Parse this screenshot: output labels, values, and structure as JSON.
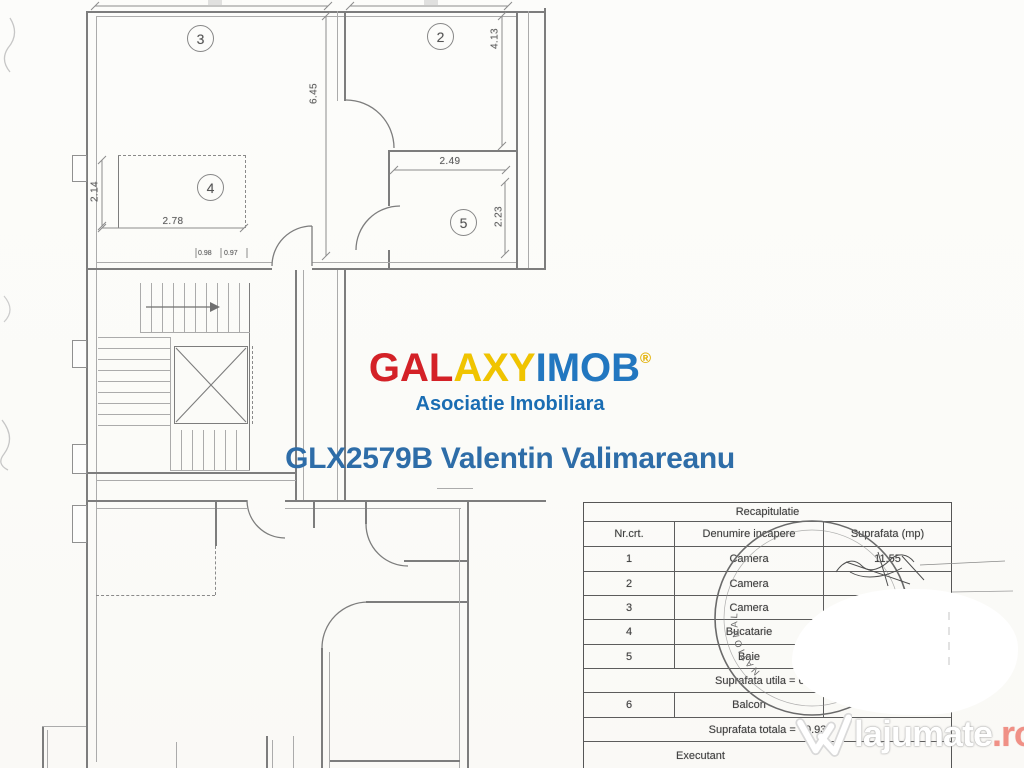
{
  "branding": {
    "logo": {
      "gal": "GAL",
      "axy": "AXY",
      "imob": "IMOB",
      "reg": "®",
      "red": "#d42127",
      "yellow": "#f0c400",
      "blue": "#2277c0"
    },
    "subtitle": "Asociatie Imobiliara",
    "agent_line": "GLX2579B Valentin Valimareanu",
    "agent_color": "#2e6da8"
  },
  "plan": {
    "rooms": {
      "r2": "2",
      "r3": "3",
      "r4": "4",
      "r5": "5"
    },
    "dims": {
      "d645": "6.45",
      "d413": "4.13",
      "d249": "2.49",
      "d223": "2.23",
      "d214": "2.14",
      "d278": "2.78",
      "d098": "0.98",
      "d097": "0.97"
    }
  },
  "table": {
    "title": "Recapitulatie",
    "headers": [
      "Nr.crt.",
      "Denumire incapere",
      "Suprafata (mp)"
    ],
    "rows": [
      {
        "nr": "1",
        "name": "Camera",
        "area": "11.55"
      },
      {
        "nr": "2",
        "name": "Camera",
        "area": ""
      },
      {
        "nr": "3",
        "name": "Camera",
        "area": ""
      },
      {
        "nr": "4",
        "name": "Bucatarie",
        "area": ""
      },
      {
        "nr": "5",
        "name": "Baie",
        "area": ""
      }
    ],
    "utila": "Suprafata utila = 63.1",
    "balcon": {
      "nr": "6",
      "name": "Balcon",
      "area": ""
    },
    "totala": "Suprafata totala = 70.93",
    "executant": "Executant"
  },
  "stamp": {
    "arc_text": "NATIONAL"
  },
  "watermark": {
    "name": "lajumate",
    "tld": ".ro",
    "tld_color": "#f09086"
  }
}
